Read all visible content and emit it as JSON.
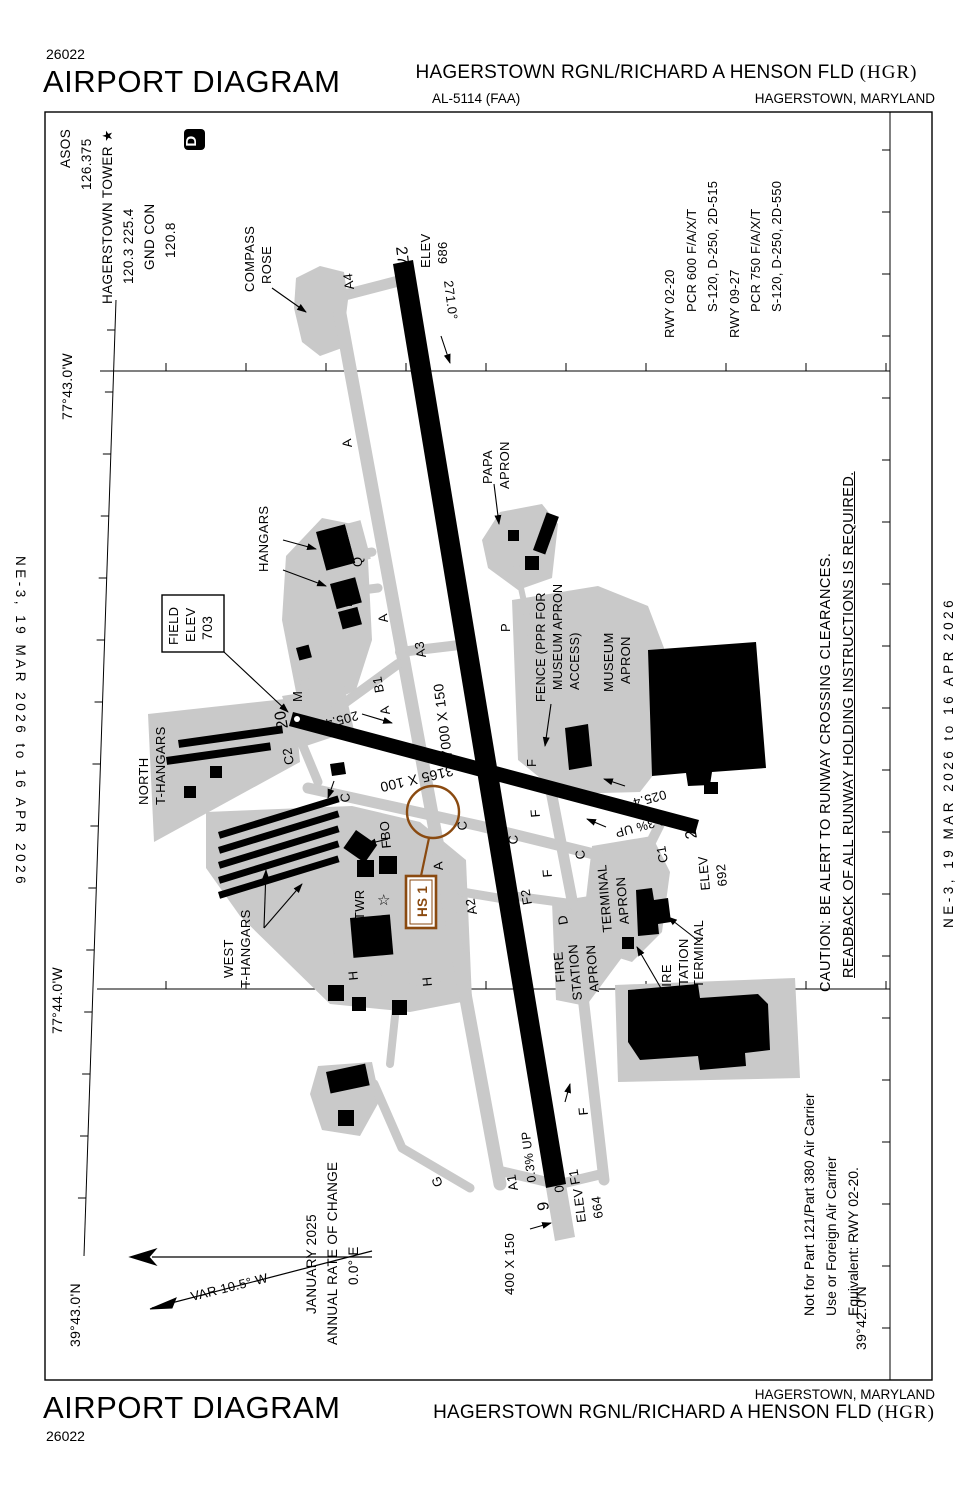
{
  "header": {
    "chart_code": "26022",
    "title": "AIRPORT DIAGRAM",
    "procedure_id": "AL-5114 (FAA)",
    "airport_name": "HAGERSTOWN RGNL/RICHARD A HENSON FLD ",
    "airport_id": "(HGR)",
    "city_state": "HAGERSTOWN, MARYLAND"
  },
  "footer": {
    "chart_code": "26022",
    "title": "AIRPORT DIAGRAM",
    "airport_name": "HAGERSTOWN RGNL/RICHARD A HENSON FLD ",
    "airport_id": "(HGR)",
    "city_state": "HAGERSTOWN, MARYLAND"
  },
  "margins": {
    "left": "NE-3,  19 MAR 2026  to  16 APR 2026",
    "right": "NE-3,  19 MAR 2026  to  16 APR 2026"
  },
  "comm": {
    "asos_label": "ASOS",
    "asos_freq": "126.375",
    "tower_label": "HAGERSTOWN TOWER ★",
    "tower_freqs": "120.3  225.4",
    "gnd_label": "GND CON",
    "gnd_freq": "120.8",
    "d_symbol": "D"
  },
  "runway_data": {
    "rwy1": "RWY 02-20",
    "rwy1_pcr": "PCR 600 F/A/X/T",
    "rwy1_strength": "S-120, D-250, 2D-515",
    "rwy2": "RWY 09-27",
    "rwy2_pcr": "PCR 750 F/A/X/T",
    "rwy2_strength": "S-120, D-250, 2D-550"
  },
  "caution": {
    "line1": "CAUTION: BE ALERT TO RUNWAY CROSSING CLEARANCES.",
    "line2": "READBACK OF ALL RUNWAY HOLDING INSTRUCTIONS IS REQUIRED."
  },
  "notes": {
    "line1": "Not for Part 121/Part 380 Air Carrier",
    "line2": "Use or Foreign Air Carrier",
    "line3": "Equivalent: RWY 02-20."
  },
  "colors": {
    "apron": "#c9c9c9",
    "hotspot": "#8a4a10",
    "ink": "#000000"
  },
  "chart_labels": [
    {
      "t": "27",
      "x": 396,
      "y": 247,
      "r": 83,
      "s": 16,
      "n": "runway-27-number"
    },
    {
      "t": "20",
      "x": 288,
      "y": 728,
      "r": -100,
      "s": 16,
      "n": "runway-20-number"
    },
    {
      "t": "9",
      "x": 549,
      "y": 1210,
      "r": -97,
      "s": 16,
      "n": "runway-9-number"
    },
    {
      "t": "2",
      "x": 697,
      "y": 838,
      "r": -100,
      "s": 16,
      "n": "runway-2-number"
    },
    {
      "t": "ELEV",
      "x": 430,
      "y": 268,
      "r": -90,
      "s": 13,
      "n": "elev-686-label"
    },
    {
      "t": "686",
      "x": 447,
      "y": 264,
      "r": -90,
      "s": 13,
      "n": "elev-686-value"
    },
    {
      "t": "ELEV",
      "x": 586,
      "y": 1222,
      "r": -97,
      "s": 13,
      "n": "elev-664-label"
    },
    {
      "t": "664",
      "x": 603,
      "y": 1218,
      "r": -97,
      "s": 13,
      "n": "elev-664-value"
    },
    {
      "t": "ELEV",
      "x": 710,
      "y": 890,
      "r": -95,
      "s": 13,
      "n": "elev-692-label"
    },
    {
      "t": "692",
      "x": 727,
      "y": 886,
      "r": -95,
      "s": 13,
      "n": "elev-692-value"
    },
    {
      "t": "FIELD",
      "x": 178,
      "y": 645,
      "r": -90,
      "s": 13,
      "n": "field-elev-label"
    },
    {
      "t": "ELEV",
      "x": 195,
      "y": 642,
      "r": -90,
      "s": 13,
      "n": "field-elev-label"
    },
    {
      "t": "703",
      "x": 212,
      "y": 640,
      "r": -90,
      "s": 14,
      "n": "field-elev-value"
    },
    {
      "t": "271.0°",
      "x": 444,
      "y": 281,
      "r": 83,
      "s": 13,
      "n": "rwy27-bearing"
    },
    {
      "t": "091.0°",
      "x": 564,
      "y": 1192,
      "r": -97,
      "s": 13,
      "n": "rwy9-bearing"
    },
    {
      "t": "205.4°",
      "x": 357,
      "y": 711,
      "r": 165,
      "s": 13,
      "n": "rwy20-bearing"
    },
    {
      "t": "025.4°",
      "x": 665,
      "y": 790,
      "r": 165,
      "s": 13,
      "n": "rwy2-bearing"
    },
    {
      "t": "0.3% UP",
      "x": 664,
      "y": 816,
      "r": 165,
      "s": 12.5,
      "n": "slope-label"
    },
    {
      "t": "0.3% UP",
      "x": 536,
      "y": 1182,
      "r": -97,
      "s": 12.5,
      "n": "slope-label"
    },
    {
      "t": "7000 X 150",
      "x": 452,
      "y": 757,
      "r": -97,
      "s": 14,
      "n": "rwy-9-27-dimensions"
    },
    {
      "t": "3165 X 100",
      "x": 452,
      "y": 766,
      "r": 167,
      "s": 14,
      "n": "rwy-2-20-dimensions"
    },
    {
      "t": "400 X 150",
      "x": 514,
      "y": 1295,
      "r": -90,
      "s": 13,
      "n": "stopway-dimensions"
    },
    {
      "t": "COMPASS",
      "x": 254,
      "y": 292,
      "r": -90,
      "s": 13,
      "n": "compass-rose-label"
    },
    {
      "t": "ROSE",
      "x": 271,
      "y": 284,
      "r": -90,
      "s": 13,
      "n": "compass-rose-label"
    },
    {
      "t": "PAPA",
      "x": 492,
      "y": 484,
      "r": -90,
      "s": 13,
      "n": "papa-apron-label"
    },
    {
      "t": "APRON",
      "x": 509,
      "y": 489,
      "r": -90,
      "s": 13,
      "n": "papa-apron-label"
    },
    {
      "t": "HANGARS",
      "x": 268,
      "y": 572,
      "r": -90,
      "s": 13,
      "n": "hangars-label"
    },
    {
      "t": "NORTH",
      "x": 148,
      "y": 805,
      "r": -90,
      "s": 13,
      "n": "north-t-hangars-label"
    },
    {
      "t": "T-HANGARS",
      "x": 165,
      "y": 805,
      "r": -90,
      "s": 13,
      "n": "north-t-hangars-label"
    },
    {
      "t": "WEST",
      "x": 233,
      "y": 978,
      "r": -90,
      "s": 13,
      "n": "west-t-hangars-label"
    },
    {
      "t": "T-HANGARS",
      "x": 250,
      "y": 988,
      "r": -90,
      "s": 13,
      "n": "west-t-hangars-label"
    },
    {
      "t": "MUSEUM",
      "x": 613,
      "y": 692,
      "r": -90,
      "s": 13,
      "n": "museum-apron-label"
    },
    {
      "t": "APRON",
      "x": 630,
      "y": 684,
      "r": -90,
      "s": 13,
      "n": "museum-apron-label"
    },
    {
      "t": "FENCE (PPR FOR",
      "x": 545,
      "y": 702,
      "r": -90,
      "s": 12.5,
      "n": "fence-note"
    },
    {
      "t": "MUSEUM APRON",
      "x": 562,
      "y": 690,
      "r": -90,
      "s": 12.5,
      "n": "fence-note"
    },
    {
      "t": "ACCESS)",
      "x": 579,
      "y": 690,
      "r": -90,
      "s": 12.5,
      "n": "fence-note"
    },
    {
      "t": "TERMINAL",
      "x": 612,
      "y": 932,
      "r": -95,
      "s": 13,
      "n": "terminal-apron-label"
    },
    {
      "t": "APRON",
      "x": 629,
      "y": 924,
      "r": -95,
      "s": 13,
      "n": "terminal-apron-label"
    },
    {
      "t": "TERMINAL",
      "x": 703,
      "y": 988,
      "r": -90,
      "s": 13,
      "n": "terminal-label"
    },
    {
      "t": "FIRE",
      "x": 671,
      "y": 995,
      "r": -90,
      "s": 13,
      "n": "fire-station-label"
    },
    {
      "t": "STATION",
      "x": 688,
      "y": 995,
      "r": -90,
      "s": 13,
      "n": "fire-station-label"
    },
    {
      "t": "FIRE",
      "x": 565,
      "y": 982,
      "r": -95,
      "s": 13,
      "n": "fire-station-apron-label"
    },
    {
      "t": "STATION",
      "x": 582,
      "y": 1000,
      "r": -95,
      "s": 13,
      "n": "fire-station-apron-label"
    },
    {
      "t": "APRON",
      "x": 599,
      "y": 992,
      "r": -95,
      "s": 13,
      "n": "fire-station-apron-label"
    },
    {
      "t": "FBO",
      "x": 391,
      "y": 848,
      "r": -95,
      "s": 13,
      "n": "fbo-label"
    },
    {
      "t": "TWR",
      "x": 364,
      "y": 920,
      "r": -90,
      "s": 13,
      "n": "tower-label"
    },
    {
      "t": "☆",
      "x": 377,
      "y": 905,
      "r": 0,
      "s": 15,
      "n": "tower-star-icon"
    },
    {
      "t": "A4",
      "x": 354,
      "y": 289,
      "r": -97,
      "s": 13,
      "n": "taxiway-label"
    },
    {
      "t": "A",
      "x": 352,
      "y": 447,
      "r": -97,
      "s": 13,
      "n": "taxiway-label"
    },
    {
      "t": "Q",
      "x": 362,
      "y": 567,
      "r": -90,
      "s": 13,
      "n": "taxiway-label"
    },
    {
      "t": "N1",
      "x": 352,
      "y": 607,
      "r": -90,
      "s": 13,
      "n": "taxiway-label"
    },
    {
      "t": "A",
      "x": 388,
      "y": 622,
      "r": -97,
      "s": 13,
      "n": "taxiway-label"
    },
    {
      "t": "A3",
      "x": 426,
      "y": 657,
      "r": -100,
      "s": 13,
      "n": "taxiway-label"
    },
    {
      "t": "B1",
      "x": 384,
      "y": 692,
      "r": -100,
      "s": 13,
      "n": "taxiway-label"
    },
    {
      "t": "A",
      "x": 390,
      "y": 714,
      "r": -100,
      "s": 13,
      "n": "taxiway-label"
    },
    {
      "t": "M",
      "x": 302,
      "y": 702,
      "r": -90,
      "s": 13,
      "n": "taxiway-label"
    },
    {
      "t": "C2",
      "x": 294,
      "y": 764,
      "r": -100,
      "s": 13,
      "n": "taxiway-label"
    },
    {
      "t": "C",
      "x": 350,
      "y": 802,
      "r": -95,
      "s": 13,
      "n": "taxiway-label"
    },
    {
      "t": "C",
      "x": 467,
      "y": 830,
      "r": -95,
      "s": 13,
      "n": "taxiway-label"
    },
    {
      "t": "C",
      "x": 518,
      "y": 844,
      "r": -95,
      "s": 13,
      "n": "taxiway-label"
    },
    {
      "t": "C",
      "x": 585,
      "y": 859,
      "r": -95,
      "s": 13,
      "n": "taxiway-label"
    },
    {
      "t": "F",
      "x": 536,
      "y": 767,
      "r": -90,
      "s": 13,
      "n": "taxiway-label"
    },
    {
      "t": "F",
      "x": 540,
      "y": 817,
      "r": -95,
      "s": 13,
      "n": "taxiway-label"
    },
    {
      "t": "A",
      "x": 443,
      "y": 870,
      "r": -95,
      "s": 13,
      "n": "taxiway-label"
    },
    {
      "t": "F",
      "x": 552,
      "y": 877,
      "r": -95,
      "s": 13,
      "n": "taxiway-label"
    },
    {
      "t": "F2",
      "x": 532,
      "y": 904,
      "r": -100,
      "s": 13,
      "n": "taxiway-label"
    },
    {
      "t": "A2",
      "x": 477,
      "y": 914,
      "r": -100,
      "s": 13,
      "n": "taxiway-label"
    },
    {
      "t": "D",
      "x": 568,
      "y": 924,
      "r": -100,
      "s": 13,
      "n": "taxiway-label"
    },
    {
      "t": "H",
      "x": 358,
      "y": 980,
      "r": -95,
      "s": 13,
      "n": "taxiway-label"
    },
    {
      "t": "H",
      "x": 432,
      "y": 986,
      "r": -95,
      "s": 13,
      "n": "taxiway-label"
    },
    {
      "t": "G",
      "x": 443,
      "y": 1185,
      "r": -110,
      "s": 13,
      "n": "taxiway-label"
    },
    {
      "t": "A1",
      "x": 518,
      "y": 1190,
      "r": -100,
      "s": 13,
      "n": "taxiway-label"
    },
    {
      "t": "F1",
      "x": 580,
      "y": 1184,
      "r": -100,
      "s": 13,
      "n": "taxiway-label"
    },
    {
      "t": "F",
      "x": 588,
      "y": 1115,
      "r": -95,
      "s": 13,
      "n": "taxiway-label"
    },
    {
      "t": "C1",
      "x": 668,
      "y": 862,
      "r": -100,
      "s": 13,
      "n": "taxiway-label"
    },
    {
      "t": "P",
      "x": 510,
      "y": 632,
      "r": -90,
      "s": 13,
      "n": "taxiway-label"
    },
    {
      "t": "HS 1",
      "x": 427,
      "y": 917,
      "r": -90,
      "s": 13.5,
      "f": "#8a4a10",
      "w": "bold",
      "n": "hotspot-label"
    },
    {
      "t": "77°43.0'W",
      "x": 72,
      "y": 420,
      "r": -90,
      "s": 14,
      "n": "longitude-label"
    },
    {
      "t": "77°44.0'W",
      "x": 62,
      "y": 1034,
      "r": -90,
      "s": 14,
      "n": "longitude-label"
    },
    {
      "t": "39°43.0'N",
      "x": 80,
      "y": 1347,
      "r": -90,
      "s": 14,
      "n": "latitude-label"
    },
    {
      "t": "39°42.0'N",
      "x": 866,
      "y": 1350,
      "r": -90,
      "s": 14,
      "n": "latitude-label"
    },
    {
      "t": "VAR 10.5° W",
      "x": 192,
      "y": 1301,
      "r": -14,
      "s": 13,
      "n": "variation-label"
    },
    {
      "t": "JANUARY 2025",
      "x": 316,
      "y": 1314,
      "r": -90,
      "s": 13.5,
      "n": "variation-date-label"
    },
    {
      "t": "ANNUAL RATE OF CHANGE",
      "x": 337,
      "y": 1345,
      "r": -90,
      "s": 13.5,
      "n": "variation-rate-label"
    },
    {
      "t": "0.0° E",
      "x": 358,
      "y": 1285,
      "r": -90,
      "s": 13.5,
      "n": "variation-rate-value"
    },
    {
      "t": "D",
      "x": 196,
      "y": 141,
      "r": -90,
      "s": 15,
      "f": "#ffffff",
      "w": "bold",
      "a": "middle",
      "n": "d-atis-symbol"
    }
  ]
}
